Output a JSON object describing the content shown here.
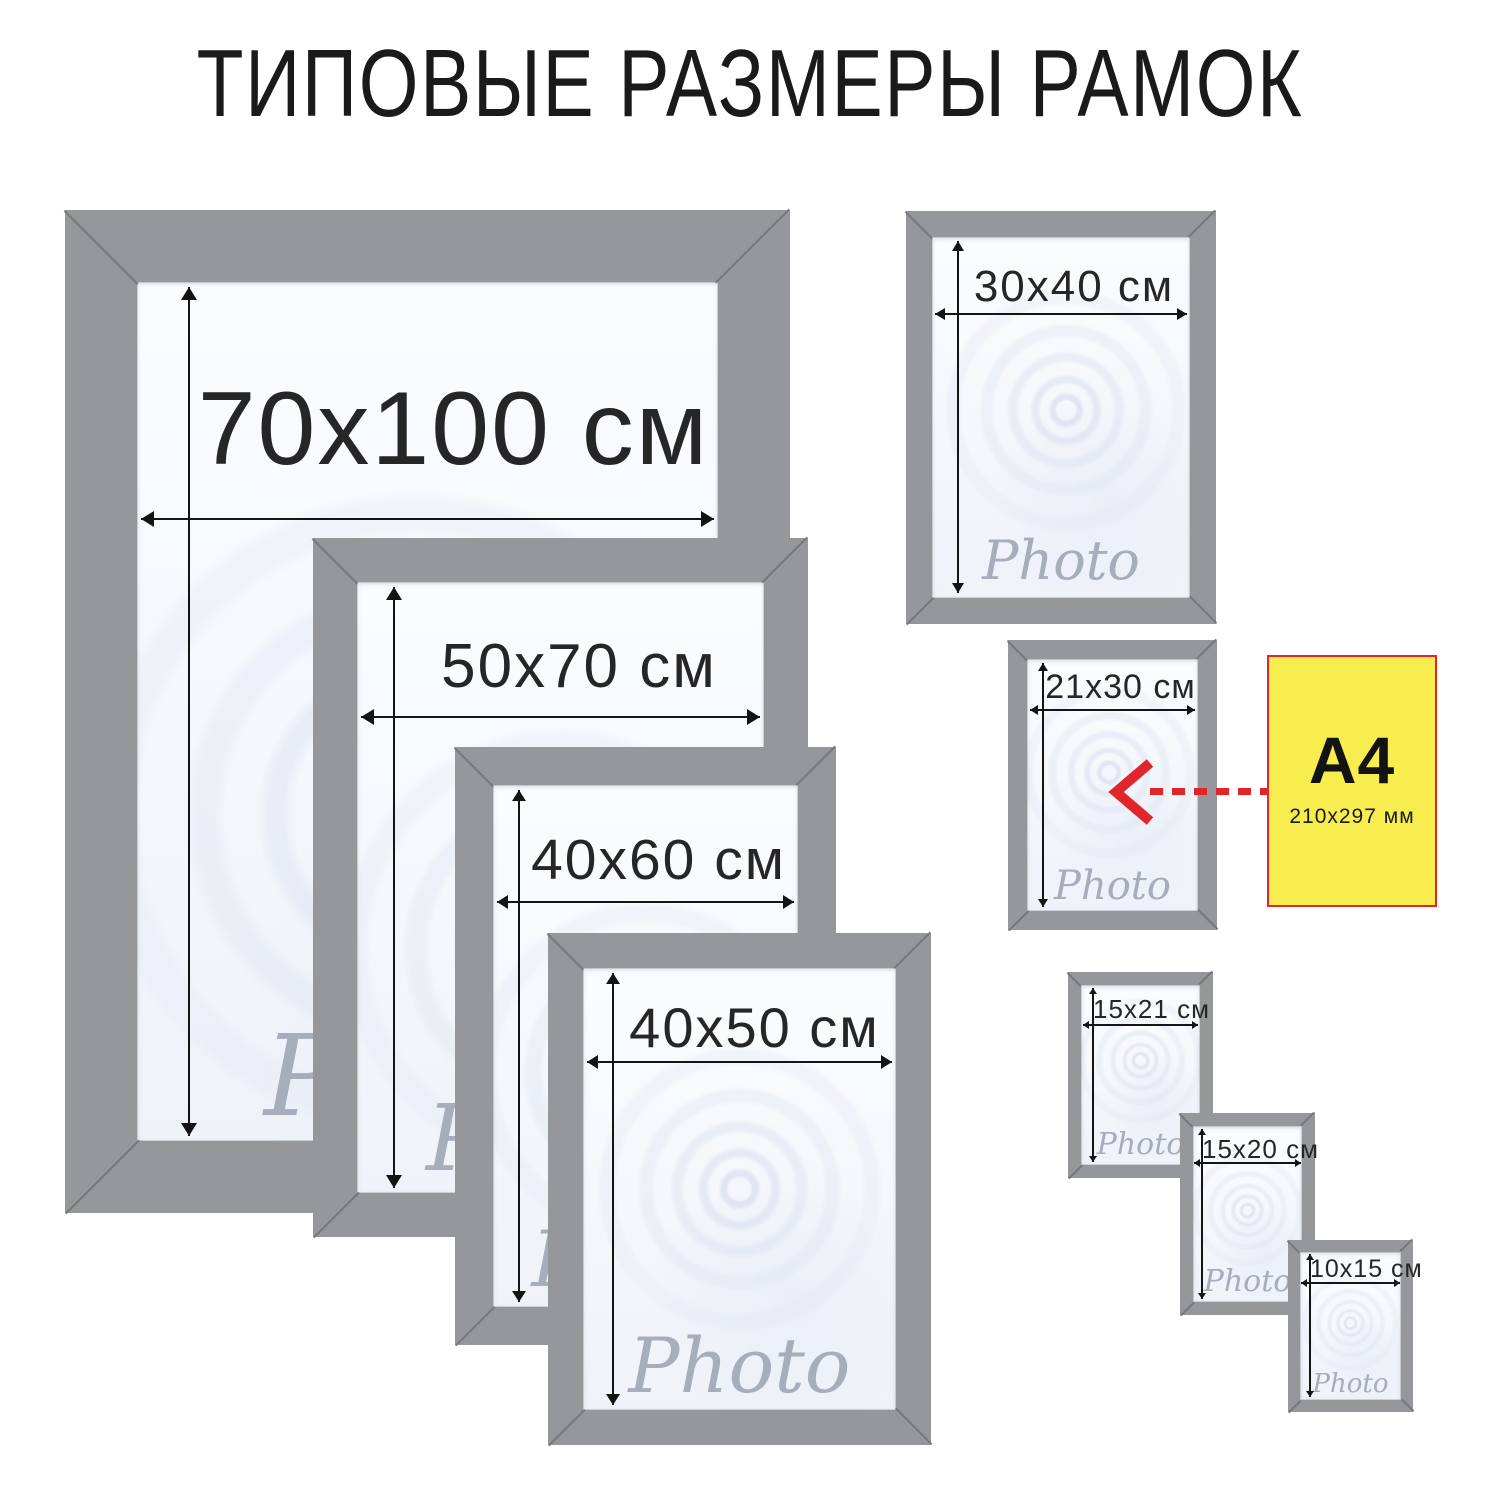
{
  "title": "ТИПОВЫЕ РАЗМЕРЫ РАМОК",
  "frames": [
    {
      "name": "70x100",
      "label": "70x100 см",
      "watermark": "Photo"
    },
    {
      "name": "50x70",
      "label": "50x70 см",
      "watermark": "Photo"
    },
    {
      "name": "40x60",
      "label": "40x60 см",
      "watermark": "Photo"
    },
    {
      "name": "40x50",
      "label": "40x50 см",
      "watermark": "Photo"
    },
    {
      "name": "30x40",
      "label": "30x40 см",
      "watermark": "Photo"
    },
    {
      "name": "21x30",
      "label": "21x30 см",
      "watermark": "Photo"
    },
    {
      "name": "15x21",
      "label": "15x21 см",
      "watermark": "Photo"
    },
    {
      "name": "15x20",
      "label": "15x20 см",
      "watermark": "Photo"
    },
    {
      "name": "10x15",
      "label": "10x15 см",
      "watermark": "Photo"
    }
  ],
  "a4": {
    "label": "A4",
    "size": "210x297 мм"
  },
  "colors": {
    "frame": "#96979b",
    "miter": "#6f7175",
    "arrow": "#141414",
    "label_color": "#262626",
    "title_color": "#1a1a1a",
    "watermark_color": "#a6adbb",
    "a4_fill": "#f8ed4f",
    "a4_border": "#e2262b",
    "red_arrow": "#e0252b"
  }
}
